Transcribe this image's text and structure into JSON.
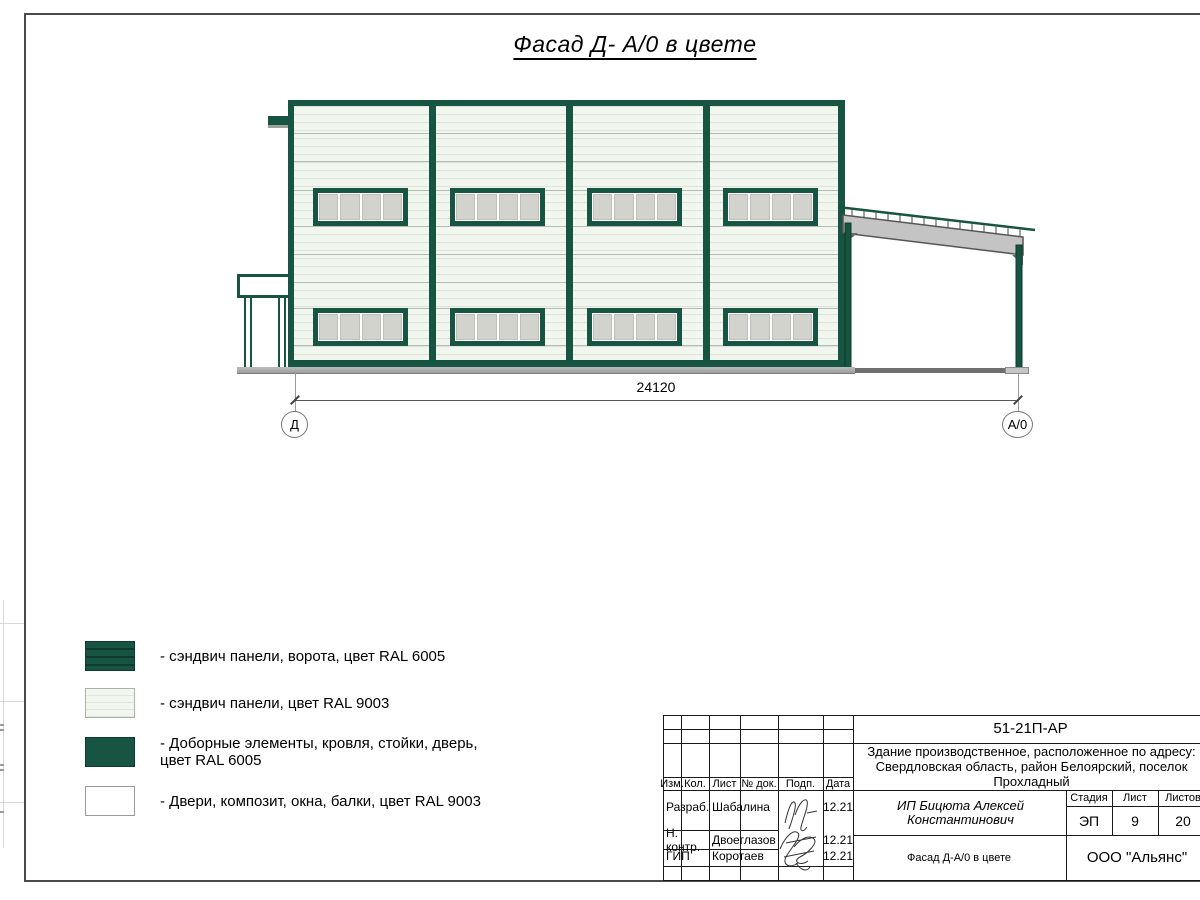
{
  "title": "Фасад Д- А/0 в цвете",
  "dimension": {
    "value": "24120"
  },
  "axes": {
    "left": "Д",
    "right": "А/0"
  },
  "legend": {
    "items": [
      {
        "label": "- сэндвич панели, ворота, цвет RAL 6005",
        "label2": ""
      },
      {
        "label": "- сэндвич панели, цвет RAL 9003",
        "label2": ""
      },
      {
        "label": "- Доборные элементы, кровля, стойки, дверь,",
        "label2": "цвет RAL 6005"
      },
      {
        "label": "- Двери, композит, окна, балки, цвет RAL 9003",
        "label2": ""
      }
    ]
  },
  "colors": {
    "ral6005": "#175441",
    "ral9003_wall": "#f1f6ef",
    "window_glass": "#d3d3ce"
  },
  "titleblock": {
    "doc_code": "51-21П-АР",
    "project": "Здание производственное, расположенное по адресу: Свердловская область, район Белоярский, поселок Прохладный",
    "client": "ИП Бицюта Алексей Константинович",
    "cols": {
      "izm": "Изм.",
      "kol": "Кол.",
      "list": "Лист",
      "ndok": "№ док.",
      "podp": "Подп.",
      "data": "Дата"
    },
    "rows": [
      {
        "role": "Разраб.",
        "name": "Шабалина",
        "date": "12.21"
      },
      {
        "role": "Н. контр.",
        "name": "Двоеглазов",
        "date": "12.21"
      },
      {
        "role": "ГИП",
        "name": "Коротаев",
        "date": "12.21"
      }
    ],
    "stage_label": "Стадия",
    "sheet_label": "Лист",
    "sheets_label": "Листов",
    "stage": "ЭП",
    "sheet": "9",
    "sheets": "20",
    "drawing_title": "Фасад Д-А/0 в цвете",
    "company": "ООО \"Альянс\""
  }
}
